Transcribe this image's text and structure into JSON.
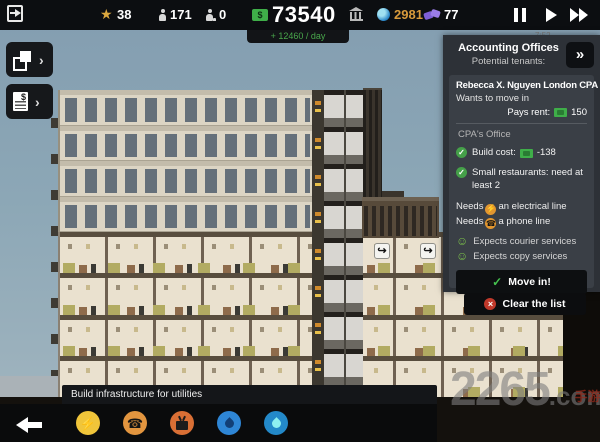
{
  "topbar": {
    "prestige": "38",
    "population": "171",
    "workers": "0",
    "money": "73540",
    "income": "+ 12460 / day",
    "influence": "2981",
    "deals": "77",
    "time": "7:52"
  },
  "panel": {
    "title": "Accounting Offices",
    "subtitle": "Potential tenants:",
    "expand": "»",
    "tenant": {
      "name": "Rebecca X. Nguyen London CPA",
      "status": "Wants to move in",
      "rent_label": "Pays rent:",
      "rent_value": "150",
      "unit_type": "CPA's Office",
      "build_cost_label": "Build cost:",
      "build_cost_value": "-138",
      "requirement": "Small restaurants: need at least 2",
      "needs": [
        {
          "prefix": "Needs",
          "item": "an electrical line"
        },
        {
          "prefix": "Needs",
          "item": "a phone line"
        }
      ],
      "expects": [
        {
          "text": "Expects courier services"
        },
        {
          "text": "Expects copy services"
        }
      ],
      "move_in": "Move in!"
    },
    "clear_list": "Clear the list"
  },
  "bottom": {
    "tooltip": "Build infrastructure for utilities"
  },
  "watermark": {
    "big": "2265",
    "small": ".com",
    "cn": "手游网"
  },
  "colors": {
    "money_green": "#3fae49",
    "income_green": "#49a84c",
    "influence_orange": "#d89a3b",
    "deals_purple": "#8a6fe0",
    "accent_green": "#45a049",
    "warn_orange": "#e2962f",
    "danger_red": "#c0392b"
  }
}
